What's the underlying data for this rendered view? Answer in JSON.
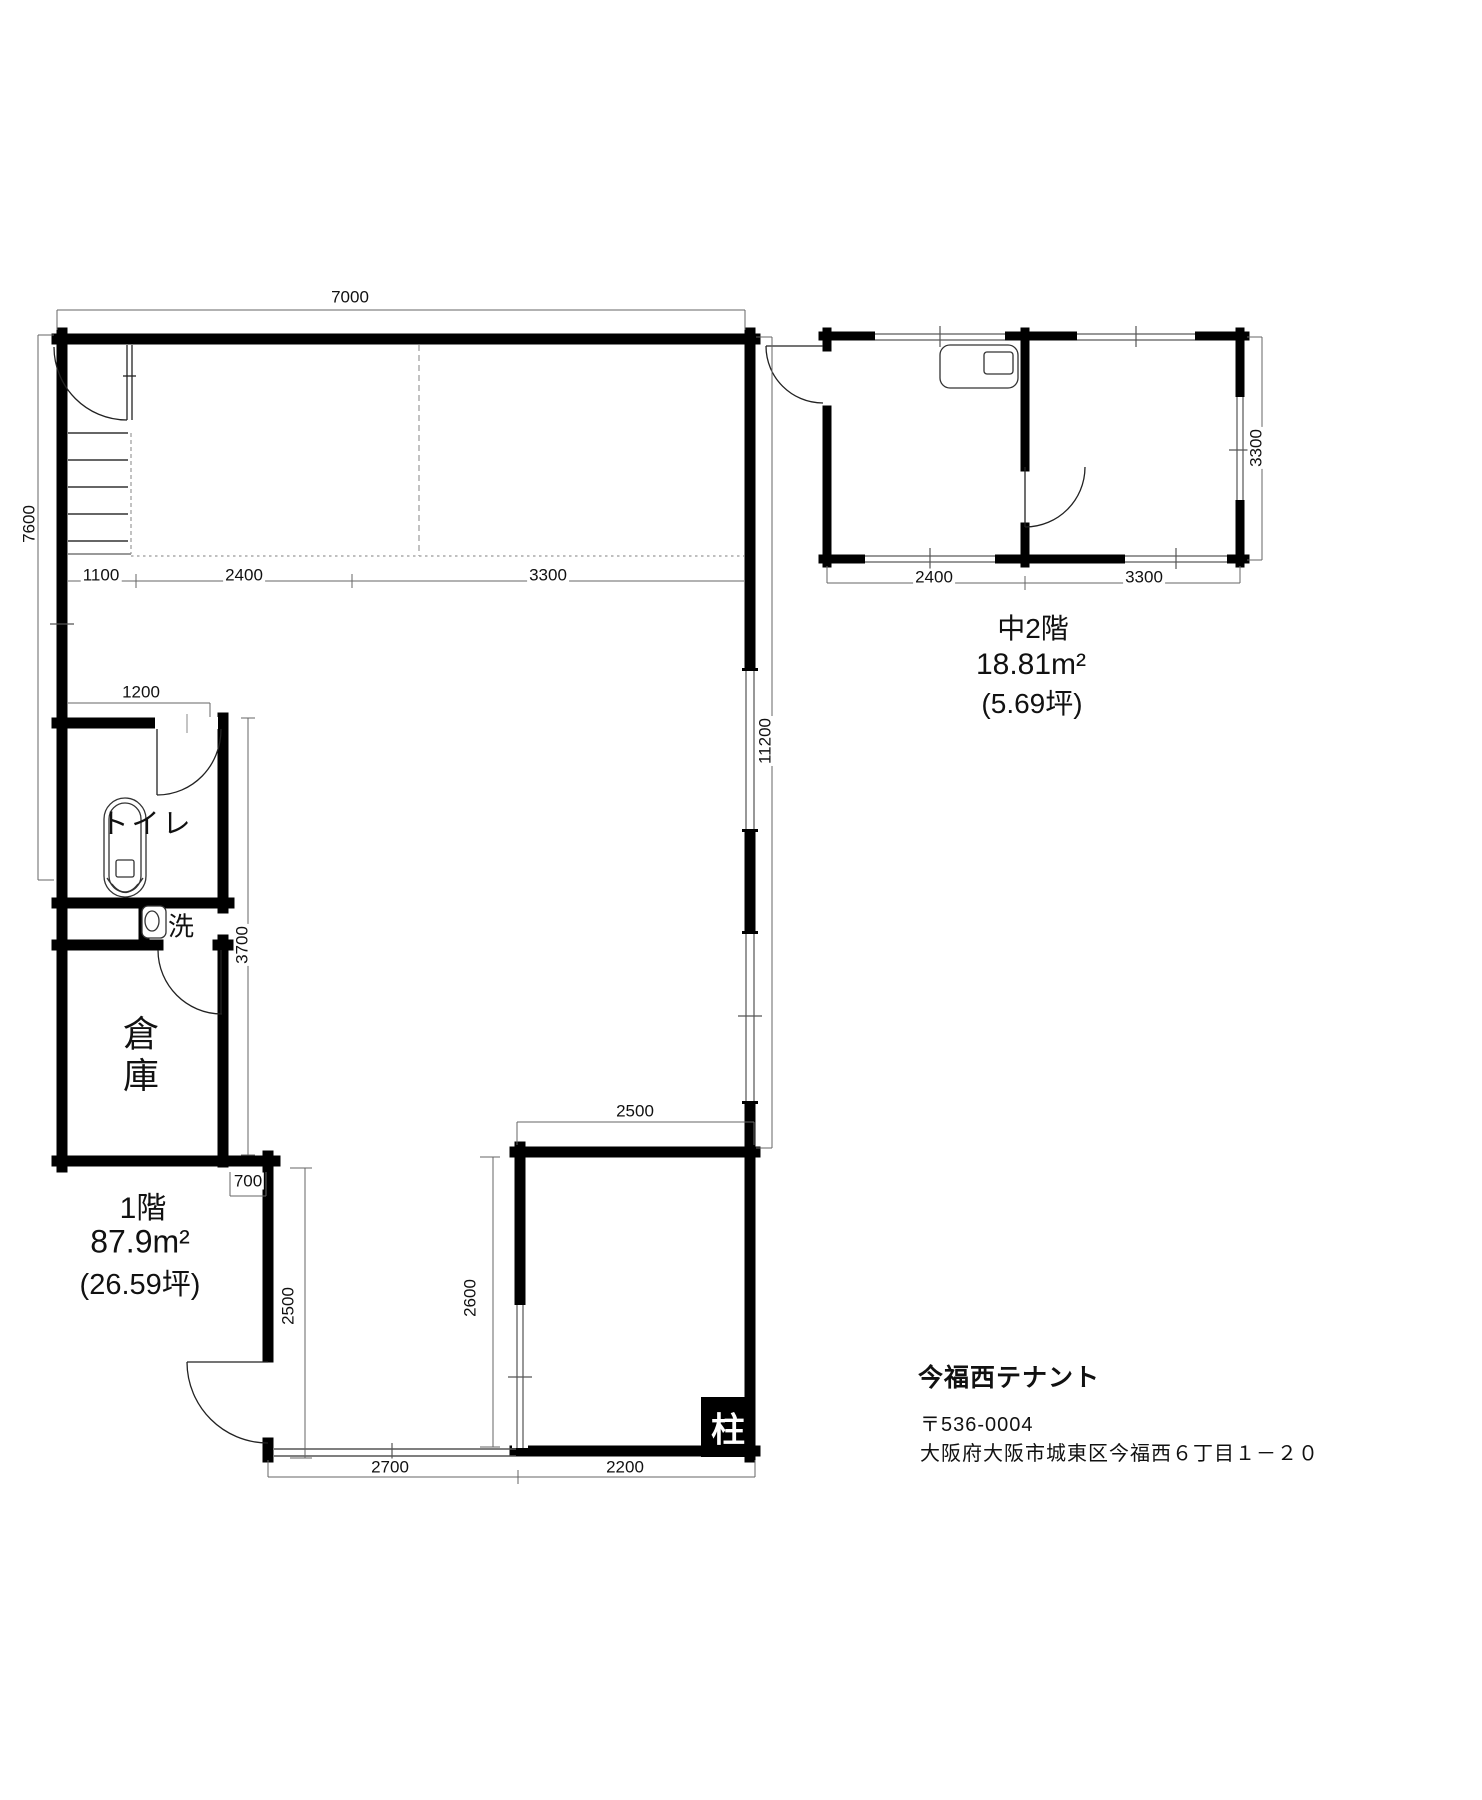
{
  "colors": {
    "ink": "#000000",
    "background": "#ffffff"
  },
  "property": {
    "title": "今福西テナント",
    "postal_code": "〒536-0004",
    "address": "大阪府大阪市城東区今福西６丁目１－２０"
  },
  "first_floor": {
    "floor_label": "1階",
    "area_sqm": "87.9m²",
    "area_tsubo": "(26.59坪)",
    "rooms": {
      "toilet": "トイレ",
      "wash": "洗",
      "storage": "倉庫",
      "pillar": "柱"
    },
    "dimensions": {
      "top_width": "7000",
      "left_height": "7600",
      "right_height": "11200",
      "stair_bay": "1100",
      "center_bay": "2400",
      "right_bay": "3300",
      "toilet_width": "1200",
      "service_column_height": "3700",
      "jog": "700",
      "lower_left_wall": "2500",
      "inner_room_width": "2500",
      "inner_room_height": "2600",
      "bottom_left": "2700",
      "bottom_right": "2200"
    }
  },
  "mezzanine": {
    "floor_label": "中2階",
    "area_sqm": "18.81m²",
    "area_tsubo": "(5.69坪)",
    "dimensions": {
      "left_room_width": "2400",
      "right_room_width": "3300",
      "depth": "3300"
    }
  }
}
